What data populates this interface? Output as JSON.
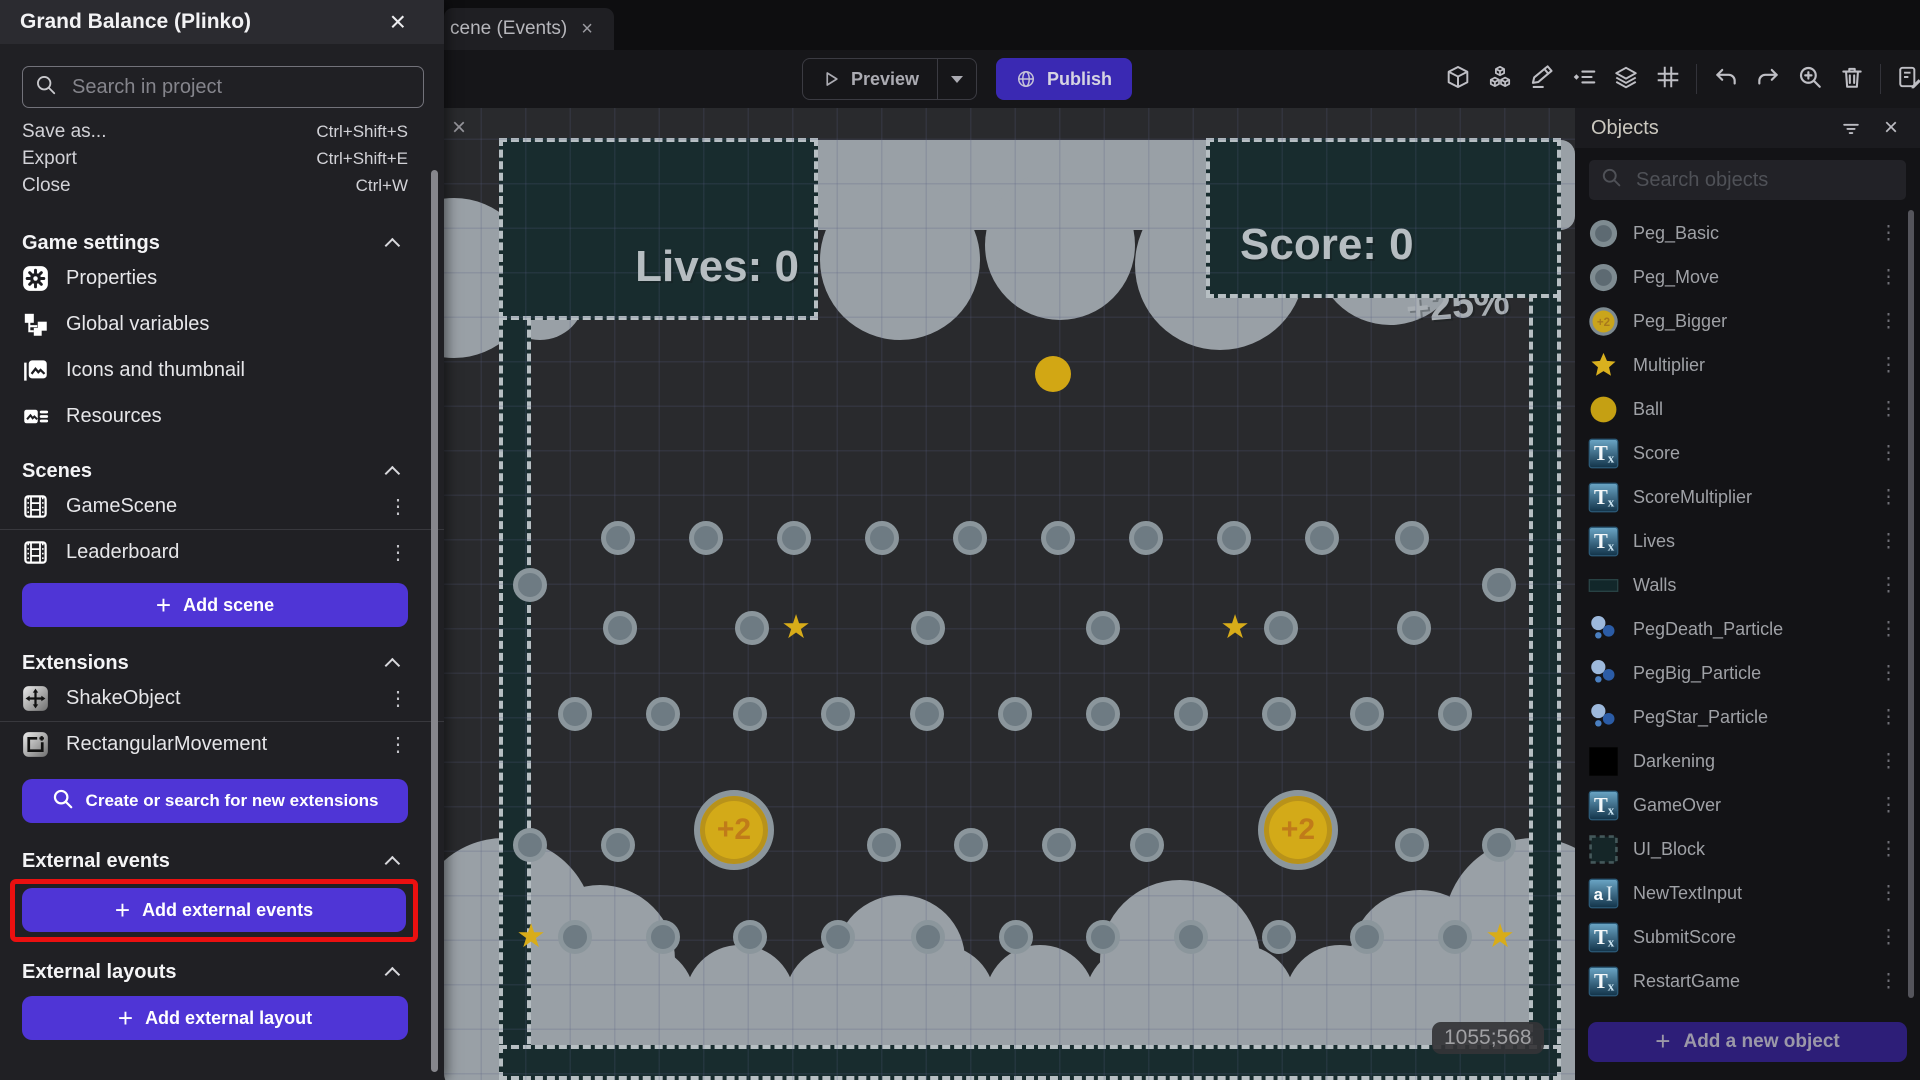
{
  "window": {
    "title_tab": "cene (Events)"
  },
  "project_panel": {
    "title": "Grand Balance (Plinko)",
    "search_placeholder": "Search in project",
    "menu_items": [
      {
        "label": "Save as...",
        "shortcut": "Ctrl+Shift+S"
      },
      {
        "label": "Export",
        "shortcut": "Ctrl+Shift+E"
      },
      {
        "label": "Close",
        "shortcut": "Ctrl+W"
      }
    ],
    "sections": {
      "game_settings": {
        "header": "Game settings",
        "items": [
          {
            "icon": "gear",
            "label": "Properties"
          },
          {
            "icon": "vars",
            "label": "Global variables"
          },
          {
            "icon": "image",
            "label": "Icons and thumbnail"
          },
          {
            "icon": "resources",
            "label": "Resources"
          }
        ]
      },
      "scenes": {
        "header": "Scenes",
        "items": [
          {
            "icon": "film",
            "label": "GameScene"
          },
          {
            "icon": "film",
            "label": "Leaderboard"
          }
        ],
        "add_button": "Add scene"
      },
      "extensions": {
        "header": "Extensions",
        "items": [
          {
            "icon": "shake",
            "label": "ShakeObject"
          },
          {
            "icon": "rectmove",
            "label": "RectangularMovement"
          }
        ],
        "search_button": "Create or search for new extensions"
      },
      "external_events": {
        "header": "External events",
        "add_button": "Add external events"
      },
      "external_layouts": {
        "header": "External layouts",
        "add_button": "Add external layout"
      }
    }
  },
  "toolbar": {
    "preview_label": "Preview",
    "publish_label": "Publish",
    "icons": [
      {
        "icon": "cube",
        "state": "active"
      },
      {
        "icon": "cubes",
        "state": "normal"
      },
      {
        "icon": "pencil",
        "state": "active"
      },
      {
        "icon": "ilist",
        "state": "normal"
      },
      {
        "icon": "layers",
        "state": "normal"
      },
      {
        "icon": "gridico",
        "state": "normal"
      },
      {
        "icon": "divider"
      },
      {
        "icon": "undo",
        "state": "normal"
      },
      {
        "icon": "redo",
        "state": "dim"
      },
      {
        "icon": "zoomin",
        "state": "normal"
      },
      {
        "icon": "trash",
        "state": "dim"
      },
      {
        "icon": "divider"
      },
      {
        "icon": "sheet",
        "state": "normal"
      }
    ]
  },
  "objects_panel": {
    "title": "Objects",
    "search_placeholder": "Search objects",
    "add_button": "Add a new object",
    "objects": [
      {
        "icon": "peg",
        "name": "Peg_Basic"
      },
      {
        "icon": "peg",
        "name": "Peg_Move"
      },
      {
        "icon": "pegbig",
        "name": "Peg_Bigger"
      },
      {
        "icon": "star",
        "name": "Multiplier"
      },
      {
        "icon": "ballico",
        "name": "Ball"
      },
      {
        "icon": "tx",
        "name": "Score"
      },
      {
        "icon": "tx",
        "name": "ScoreMultiplier"
      },
      {
        "icon": "tx",
        "name": "Lives"
      },
      {
        "icon": "wallico",
        "name": "Walls"
      },
      {
        "icon": "particle",
        "name": "PegDeath_Particle"
      },
      {
        "icon": "particle",
        "name": "PegBig_Particle"
      },
      {
        "icon": "particle",
        "name": "PegStar_Particle"
      },
      {
        "icon": "blackico",
        "name": "Darkening"
      },
      {
        "icon": "tx",
        "name": "GameOver"
      },
      {
        "icon": "uiblock",
        "name": "UI_Block"
      },
      {
        "icon": "textinput",
        "name": "NewTextInput"
      },
      {
        "icon": "tx",
        "name": "SubmitScore"
      },
      {
        "icon": "tx",
        "name": "RestartGame"
      }
    ]
  },
  "scene": {
    "hud_lives": "Lives: 0",
    "hud_score": "Score: 0",
    "multiplier_text": "+25%",
    "coords": "1055;568",
    "pegs": [
      {
        "x": 174,
        "y": 430
      },
      {
        "x": 262,
        "y": 430
      },
      {
        "x": 350,
        "y": 430
      },
      {
        "x": 438,
        "y": 430
      },
      {
        "x": 526,
        "y": 430
      },
      {
        "x": 614,
        "y": 430
      },
      {
        "x": 702,
        "y": 430
      },
      {
        "x": 790,
        "y": 430
      },
      {
        "x": 878,
        "y": 430
      },
      {
        "x": 968,
        "y": 430
      },
      {
        "x": 86,
        "y": 477
      },
      {
        "x": 1055,
        "y": 477
      },
      {
        "x": 176,
        "y": 520
      },
      {
        "x": 308,
        "y": 520
      },
      {
        "x": 484,
        "y": 520
      },
      {
        "x": 659,
        "y": 520
      },
      {
        "x": 837,
        "y": 520
      },
      {
        "x": 970,
        "y": 520
      },
      {
        "x": 131,
        "y": 606
      },
      {
        "x": 219,
        "y": 606
      },
      {
        "x": 306,
        "y": 606
      },
      {
        "x": 394,
        "y": 606
      },
      {
        "x": 483,
        "y": 606
      },
      {
        "x": 571,
        "y": 606
      },
      {
        "x": 659,
        "y": 606
      },
      {
        "x": 747,
        "y": 606
      },
      {
        "x": 835,
        "y": 606
      },
      {
        "x": 923,
        "y": 606
      },
      {
        "x": 1011,
        "y": 606
      },
      {
        "x": 86,
        "y": 737
      },
      {
        "x": 174,
        "y": 737
      },
      {
        "x": 440,
        "y": 737
      },
      {
        "x": 527,
        "y": 737
      },
      {
        "x": 615,
        "y": 737
      },
      {
        "x": 703,
        "y": 737
      },
      {
        "x": 968,
        "y": 737
      },
      {
        "x": 1055,
        "y": 737
      },
      {
        "x": 131,
        "y": 829
      },
      {
        "x": 219,
        "y": 829
      },
      {
        "x": 306,
        "y": 829
      },
      {
        "x": 394,
        "y": 829
      },
      {
        "x": 484,
        "y": 829
      },
      {
        "x": 572,
        "y": 829
      },
      {
        "x": 659,
        "y": 829
      },
      {
        "x": 747,
        "y": 829
      },
      {
        "x": 835,
        "y": 829
      },
      {
        "x": 923,
        "y": 829
      },
      {
        "x": 1011,
        "y": 829
      }
    ],
    "stars": [
      {
        "x": 352,
        "y": 520
      },
      {
        "x": 791,
        "y": 520
      },
      {
        "x": 87,
        "y": 829
      },
      {
        "x": 1056,
        "y": 829
      }
    ],
    "big_pegs": [
      {
        "x": 290,
        "y": 722,
        "label": "+2"
      },
      {
        "x": 854,
        "y": 722,
        "label": "+2"
      }
    ],
    "ball": {
      "x": 609,
      "y": 266
    }
  },
  "colors": {
    "accent_purple": "#4f35d6",
    "publish_purple": "#3a29b3",
    "highlight_red": "#ea1010",
    "teal_wall": "#182c2e",
    "cloud_gray": "#99a0a6",
    "gold": "#d2a714",
    "active_icon_bg": "#6f639e"
  }
}
